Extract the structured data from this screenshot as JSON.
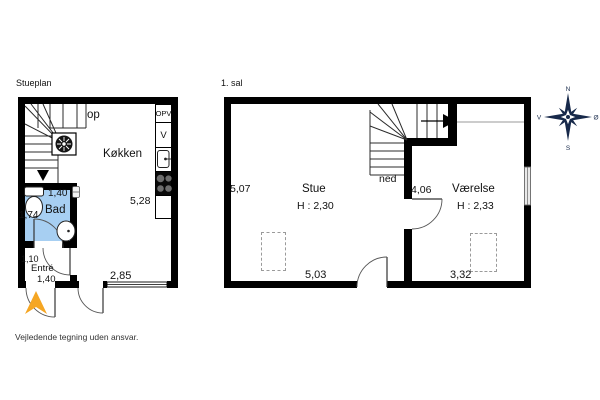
{
  "document": {
    "footer_disclaimer": "Vejledende tegning uden ansvar."
  },
  "ground_floor": {
    "title": "Stueplan",
    "labels": {
      "kitchen": "Køkken",
      "bath": "Bad",
      "entry": "Entré",
      "stairs_up": "op",
      "dishwasher": "OPV",
      "washer": "V"
    },
    "dimensions": {
      "bath_width": "1,40",
      "bath_depth": "1,74",
      "entry_depth": "1,10",
      "entry_width": "1,40",
      "kitchen_depth": "5,28",
      "kitchen_width": "2,85"
    }
  },
  "first_floor": {
    "title": "1. sal",
    "labels": {
      "living_room": "Stue",
      "living_room_ceiling": "H : 2,30",
      "bedroom": "Værelse",
      "bedroom_ceiling": "H : 2,33",
      "stairs_down": "ned"
    },
    "dimensions": {
      "living_depth": "5,07",
      "living_width": "5,03",
      "stair_partition": "4,06",
      "bedroom_width": "3,32"
    }
  },
  "compass": {
    "north": "N",
    "east": "Ø",
    "south": "S",
    "west": "V"
  },
  "colors": {
    "bath_fill": "#A7CFF2",
    "entry_arrow": "#F5A623",
    "compass": "#17294A",
    "wall": "#000000"
  }
}
